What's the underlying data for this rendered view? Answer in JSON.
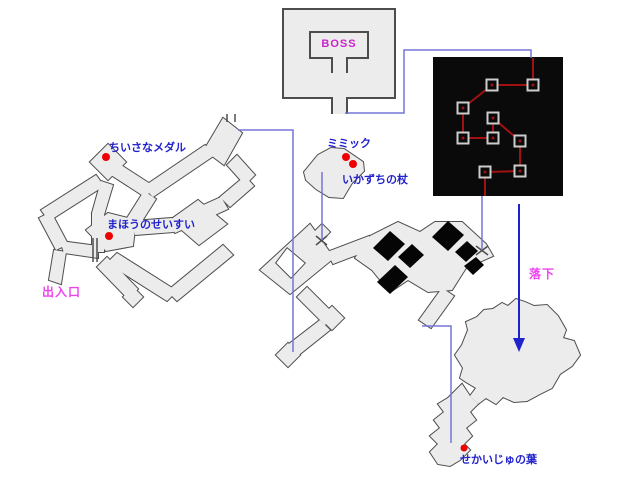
{
  "canvas": {
    "width": 640,
    "height": 478,
    "background": "#ffffff"
  },
  "colors": {
    "maze_fill": "#ececec",
    "maze_stroke": "#4d4d4d",
    "connector_blue": "#7575d8",
    "arrow_blue": "#2222cc",
    "label_blue": "#2222cc",
    "label_magenta_boss": "#cc22cc",
    "label_pink": "#ee44ee",
    "item_dot_red": "#ee0000",
    "dark_room_fill": "#0a0a0a",
    "route_red": "#a01212",
    "node_square_gray": "#cccccc"
  },
  "labels": [
    {
      "id": "boss",
      "text": "BOSS",
      "x": 339,
      "y": 47,
      "color": "#cc22cc",
      "size": 11,
      "anchor": "middle",
      "spacing": 1
    },
    {
      "id": "medal",
      "text": "ちいさなメダル",
      "x": 109,
      "y": 151,
      "color": "#2222cc",
      "size": 11,
      "anchor": "start",
      "spacing": 0
    },
    {
      "id": "seisui",
      "text": "まほうのせいすい",
      "x": 107,
      "y": 228,
      "color": "#2222cc",
      "size": 11,
      "anchor": "start",
      "spacing": 0
    },
    {
      "id": "entrance",
      "text": "出入口",
      "x": 42,
      "y": 296,
      "color": "#ee44ee",
      "size": 12,
      "anchor": "start",
      "spacing": 1
    },
    {
      "id": "mimic",
      "text": "ミミック",
      "x": 327,
      "y": 147,
      "color": "#2222cc",
      "size": 11,
      "anchor": "start",
      "spacing": 0
    },
    {
      "id": "staff",
      "text": "いかずちの杖",
      "x": 342,
      "y": 183,
      "color": "#2222cc",
      "size": 11,
      "anchor": "start",
      "spacing": 0
    },
    {
      "id": "fall",
      "text": "落下",
      "x": 529,
      "y": 278,
      "color": "#ee44ee",
      "size": 12,
      "anchor": "start",
      "spacing": 1
    },
    {
      "id": "leaf",
      "text": "せかいじゅの葉",
      "x": 460,
      "y": 463,
      "color": "#2222cc",
      "size": 11,
      "anchor": "start",
      "spacing": 0
    }
  ],
  "item_dots": [
    {
      "id": "small-medal",
      "x": 106,
      "y": 157,
      "r": 4
    },
    {
      "id": "holy-water",
      "x": 109,
      "y": 236,
      "r": 4
    },
    {
      "id": "mimic-chest",
      "x": 346,
      "y": 157,
      "r": 4
    },
    {
      "id": "thunder-staff",
      "x": 353,
      "y": 164,
      "r": 4
    },
    {
      "id": "yggdrasil-leaf",
      "x": 464,
      "y": 448,
      "r": 3.5
    }
  ],
  "boss_room": {
    "fill_pts": "283,9 395,9 395,98 347,98 347,114 332,114 332,98 283,98",
    "wall_path": "M332,114 L332,98 L283,98 L283,9 L395,9 L395,98 L347,98 L347,114",
    "inner_path": "M332,73 L332,58 L310,58 L310,32 L368,32 L368,58 L347,58 L347,73"
  },
  "dark_room": {
    "x": 433,
    "y": 57,
    "w": 130,
    "h": 139,
    "edges": [
      [
        533,
        58,
        533,
        85
      ],
      [
        533,
        85,
        492,
        85
      ],
      [
        492,
        85,
        463,
        108
      ],
      [
        463,
        108,
        463,
        138
      ],
      [
        463,
        138,
        493,
        138
      ],
      [
        493,
        118,
        493,
        138
      ],
      [
        493,
        118,
        520,
        141
      ],
      [
        520,
        141,
        520,
        171
      ],
      [
        520,
        171,
        485,
        172
      ],
      [
        485,
        172,
        485,
        196
      ]
    ],
    "nodes": [
      [
        492,
        85
      ],
      [
        533,
        85
      ],
      [
        463,
        108
      ],
      [
        493,
        118
      ],
      [
        463,
        138
      ],
      [
        493,
        138
      ],
      [
        520,
        141
      ],
      [
        520,
        171
      ],
      [
        485,
        172
      ]
    ],
    "node_size": 11
  },
  "maze_groups": [
    {
      "name": "left-maze",
      "shapes": [
        "90,162 108,144 126,162 108,180",
        "111,175 121,165 155,187 145,197",
        "143,187 153,197 215,155 205,145",
        "204,150 223,118 242,133 224,165",
        "227,165 237,155 255,175 245,185",
        "245,176 254,186 230,207 220,197",
        "221,197 228,209 175,233 168,221",
        "170,220 198,200 227,224 199,245",
        "133,221 172,218 174,232 135,235",
        "86,230 108,213 136,220 133,246 106,251",
        "96,175 104,186 49,221 41,210",
        "39,218 51,212 68,244 56,250",
        "60,241 64,253 98,258 98,246",
        "92,252 104,252 104,213 92,213",
        "92,213 104,215 113,185 101,181",
        "54,250 66,252 61,284 49,280",
        "97,267 107,257 138,289 128,299",
        "123,297 133,287 143,297 133,307",
        "107,263 117,253 177,291 167,301",
        "167,291 177,301 233,255 223,245",
        "144,191 156,199 139,226 127,218"
      ]
    },
    {
      "name": "mimic-room",
      "shapes": [
        "304,172 318,155 331,148 344,149 363,162 364,171 352,183 343,198 329,197 316,189 306,180"
      ]
    },
    {
      "name": "center-maze",
      "ring": {
        "outer": "310,224 334,258 290,294 260,270",
        "inner": "287,247 306,263 291,279 275,263"
      },
      "shapes": [
        "313,233 322,224 330,232 321,241",
        "327,252 333,264 375,248 369,236",
        "370,236 398,222 420,232 435,222 462,222 486,244 493,256 466,268 452,290 428,292 408,280 390,292 372,270 355,258",
        "442,288 454,296 431,328 419,320",
        "297,297 307,287 335,315 325,325",
        "320,318 332,306 344,318 332,330",
        "320,320 330,330 295,358 285,347",
        "276,355 288,343 300,355 288,367"
      ]
    },
    {
      "name": "bottom-rooms",
      "shapes": [
        "525,302 534,306 547,305 558,316 566,330 563,338 574,341 580,355 572,366 560,374 552,388 540,394 527,401 514,402 503,397 496,404 486,398 478,404 470,396 476,388 466,382 460,378 463,368 455,355 462,345 468,330 466,322 477,317 484,310 493,309 502,303 508,306 516,299",
        "470,396 478,404 470,412 476,420 466,428 472,436 464,444 470,450 460,460 450,466 438,464 430,452 438,444 430,436 440,428 434,420 444,412 438,404 448,398 456,390 462,384"
      ]
    }
  ],
  "dark_areas": [
    "373,248 390,231 405,244 388,261",
    "398,257 412,244 424,255 410,268",
    "432,237 448,221 464,235 448,251",
    "455,252 467,241 478,251 466,262",
    "377,282 395,265 408,277 390,294",
    "464,266 476,257 484,265 473,275"
  ],
  "wall_lines": [
    [
      93,
      238,
      93,
      262
    ],
    [
      97,
      238,
      97,
      262
    ]
  ],
  "door_ticks": [
    [
      227,
      122,
      227,
      114
    ],
    [
      235,
      122,
      235,
      114
    ],
    [
      316,
      236,
      327,
      245
    ],
    [
      316,
      245,
      327,
      236
    ],
    [
      476,
      246,
      488,
      255
    ],
    [
      476,
      255,
      488,
      246
    ]
  ],
  "connectors": [
    {
      "id": "boss-to-darkroom",
      "pts": "345,113 404,113 404,50 531,50 531,58"
    },
    {
      "id": "leftmaze-to-center",
      "pts": "238,130 293,130 293,352"
    },
    {
      "id": "mimic-to-center",
      "pts": "322,172 322,240"
    },
    {
      "id": "darkroom-to-center",
      "pts": "482,196 482,250"
    },
    {
      "id": "center-to-leafroom",
      "pts": "422,326 451,326 451,443"
    }
  ],
  "fall_arrow": {
    "x": 519,
    "y1": 204,
    "y2": 342,
    "head": "519,352 513,338 525,338"
  }
}
